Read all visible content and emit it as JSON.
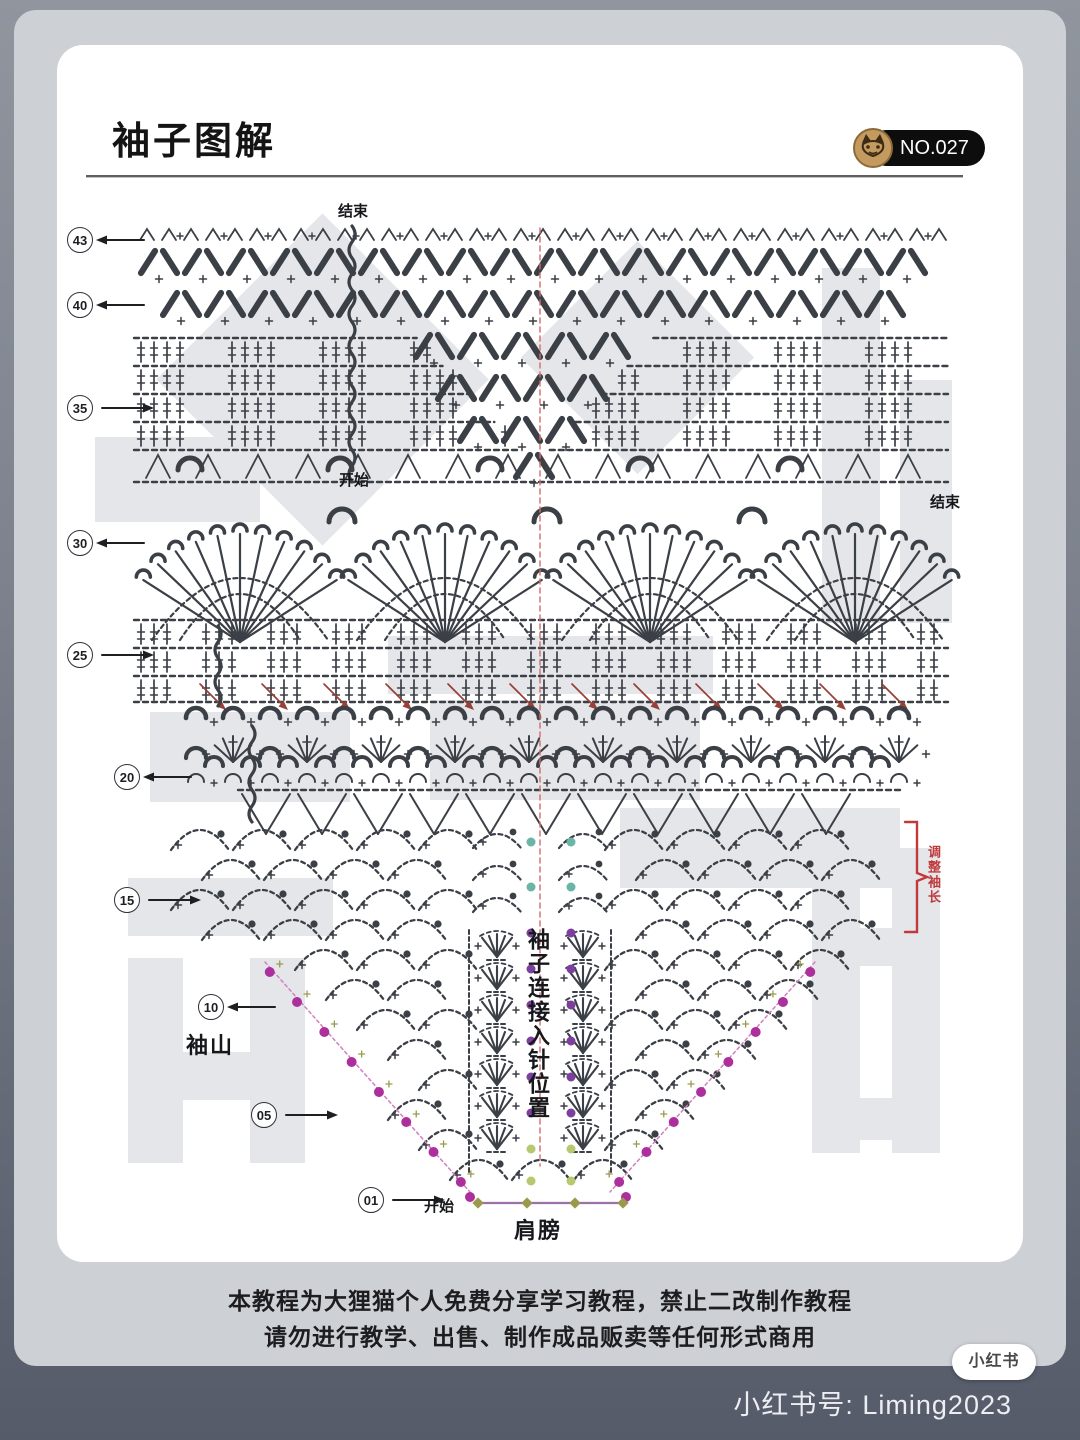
{
  "page": {
    "title": "袖子图解",
    "badge": {
      "number": "NO.027",
      "icon": "cat-icon"
    },
    "disclaimer_line1": "本教程为大狸猫个人免费分享学习教程，禁止二改制作教程",
    "disclaimer_line2": "请勿进行教学、出售、制作成品贩卖等任何形式商用",
    "bottom_bar": {
      "account_label": "小红书号: Liming2023",
      "logo_text": "小红书"
    }
  },
  "chart": {
    "labels": {
      "end_top": "结束",
      "start_mid": "开始",
      "end_mid": "结束",
      "sleeve_cap": "袖山",
      "start_bottom": "开始",
      "shoulder": "肩膀",
      "center_vertical": "袖子连接入针位置",
      "adjust_length": "调整袖长"
    },
    "row_markers": [
      {
        "num": "43",
        "x": 80,
        "y": 240,
        "dir": "left"
      },
      {
        "num": "40",
        "x": 80,
        "y": 305,
        "dir": "left"
      },
      {
        "num": "35",
        "x": 80,
        "y": 408,
        "dir": "right"
      },
      {
        "num": "30",
        "x": 80,
        "y": 543,
        "dir": "left"
      },
      {
        "num": "25",
        "x": 80,
        "y": 655,
        "dir": "right"
      },
      {
        "num": "20",
        "x": 127,
        "y": 777,
        "dir": "left"
      },
      {
        "num": "15",
        "x": 127,
        "y": 900,
        "dir": "right"
      },
      {
        "num": "10",
        "x": 211,
        "y": 1007,
        "dir": "left"
      },
      {
        "num": "05",
        "x": 264,
        "y": 1115,
        "dir": "right"
      },
      {
        "num": "01",
        "x": 371,
        "y": 1200,
        "dir": "right"
      }
    ],
    "colors": {
      "stitch": "#3b3f46",
      "red": "#c03a3a",
      "red_dash": "#d96a6a",
      "red_arrow": "#964038",
      "magenta": "#ad2f9c",
      "purple": "#7d3f9e",
      "teal": "#6ab5a5",
      "green": "#b7c96e",
      "olive": "#9a9a4e",
      "watermark": "#e4e6ea",
      "shoulder_line": "#9b6faa"
    },
    "center_dots": {
      "columns": [
        531,
        571
      ],
      "teal_y": [
        842,
        887
      ],
      "purple_y": [
        933,
        969,
        1005,
        1041,
        1077,
        1113
      ],
      "green_y": [
        1149,
        1181
      ]
    },
    "fan_centers": [
      240,
      445,
      650,
      855
    ],
    "leaf_columns": [
      497,
      583
    ]
  }
}
